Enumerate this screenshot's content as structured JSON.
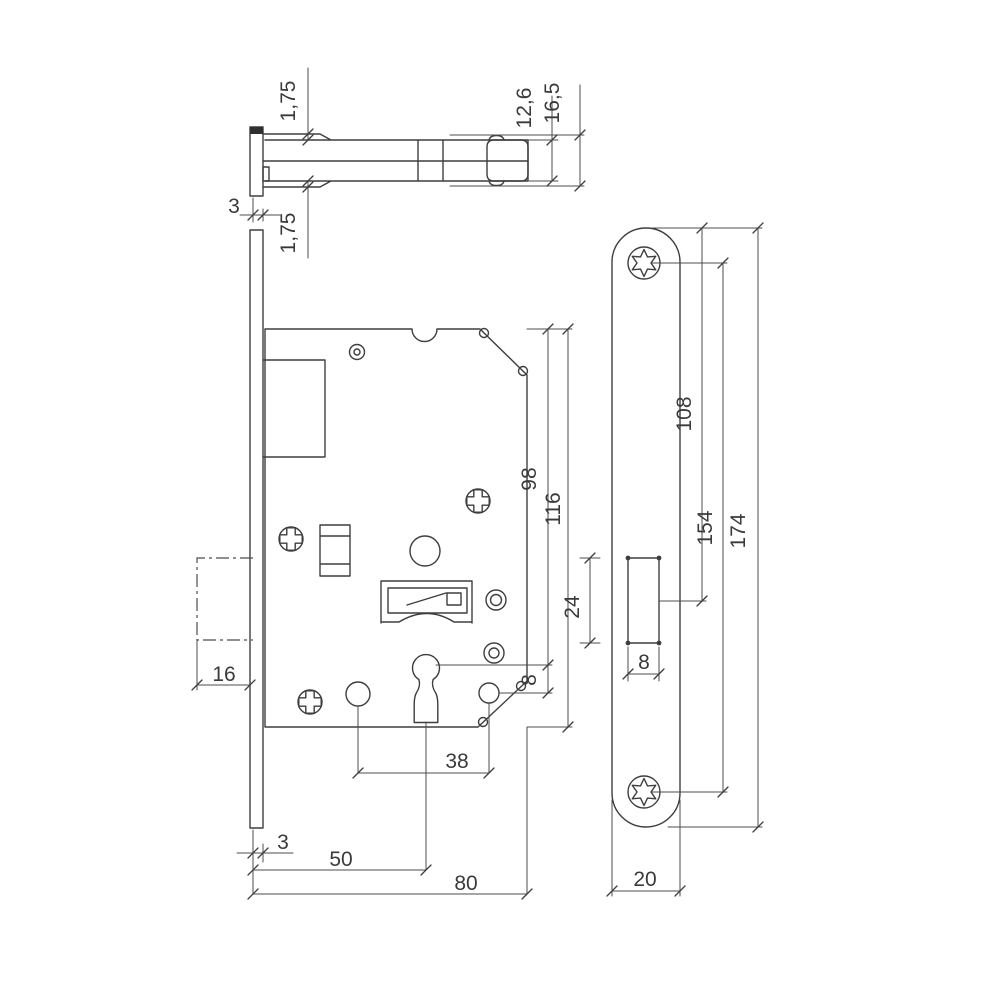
{
  "drawing": {
    "ink_color": "#3e3e3e",
    "background": "#ffffff",
    "dims": {
      "top": {
        "flange_top": "1,75",
        "flange_bottom": "1,75",
        "plate_thickness": "3",
        "latch_height_inner": "12,6",
        "latch_height_outer": "16,5"
      },
      "front": {
        "latch_protrusion": "16",
        "top_to_keyhole": "98",
        "case_height": "116",
        "keyhole_to_hole": "8",
        "hole_spacing": "38",
        "plate_thickness": "3",
        "backset": "50",
        "case_depth": "80"
      },
      "face": {
        "top_to_cutout": "108",
        "screw_spacing": "154",
        "plate_height": "174",
        "cutout_height": "24",
        "cutout_width": "8",
        "plate_width": "20"
      }
    }
  }
}
